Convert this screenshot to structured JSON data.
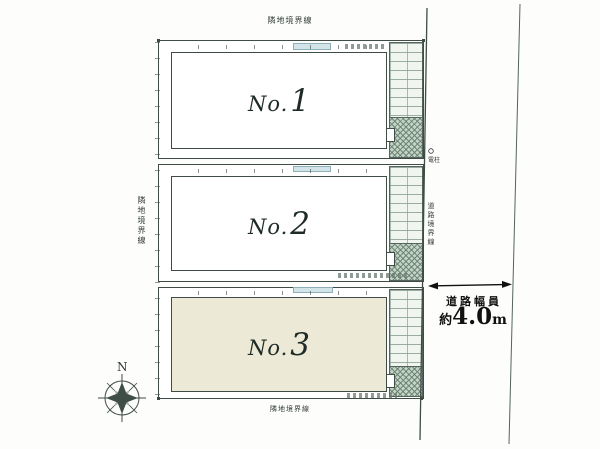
{
  "labels": {
    "boundary_top": "隣地境界線",
    "boundary_left": "隣地境界線",
    "boundary_bottom": "隣地境界線",
    "boundary_road": "道路境界線",
    "utility_pole": "電柱",
    "compass_north": "N"
  },
  "road_width": {
    "caption": "道路幅員",
    "approx": "約",
    "value": "4.0",
    "unit": "m"
  },
  "lots": [
    {
      "prefix": "No.",
      "number": "1"
    },
    {
      "prefix": "No.",
      "number": "2"
    },
    {
      "prefix": "No.",
      "number": "3"
    }
  ],
  "colors": {
    "line": "#3e4c45",
    "lot3_fill": "#ece9d6",
    "tile_fill": "#f1f5ef",
    "hatch_fill": "#c3d4c6",
    "band_fill": "#d3e4e8"
  }
}
